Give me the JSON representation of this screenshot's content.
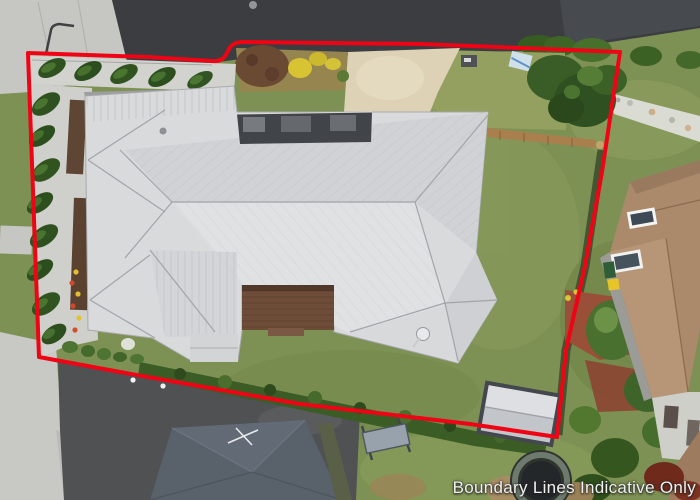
{
  "image": {
    "kind": "aerial-property-photo",
    "caption": "Boundary Lines Indicative Only"
  },
  "boundary": {
    "color": "#ee0414",
    "description": "red polygon outlining the property"
  },
  "palette": {
    "grass": "#7e9154",
    "road": "#3b3d40",
    "sidewalk": "#c6c7c3",
    "asphalt_drive": "#505153",
    "main_roof": "#d9dadc",
    "south_neighbour_roof": "#59616b",
    "east_neighbour_roof": "#ab8a6c",
    "driveway_concrete": "#ddd2b6",
    "diamond_path": "#eceae4",
    "diamond": "#595c60",
    "deck": "#6d4c38",
    "hedge": "#3c5c26",
    "conifer": "#2f5120"
  },
  "features": [
    "street at top",
    "footpath along left",
    "main house with light grey metal hip roof",
    "diamond patterned front path",
    "beige concrete driveway",
    "row of conifers along left boundary",
    "timber deck",
    "satellite dish on roof",
    "rear lawn",
    "garden shed near rear boundary",
    "trampoline in neighbouring yard",
    "swing seat in neighbouring yard",
    "south neighbour house with dark grey roof and tv antenna",
    "east neighbour house with brown roof",
    "white stone garden strip on right verge",
    "yellow flowering shrubs and brown bush in front garden"
  ]
}
